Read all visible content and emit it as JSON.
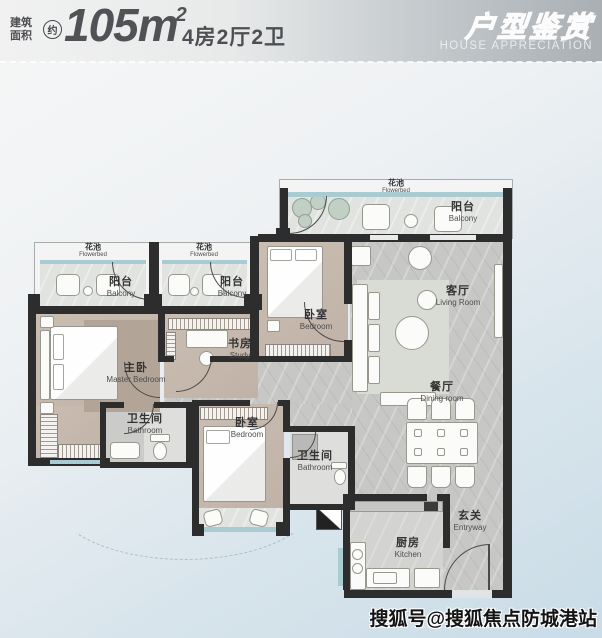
{
  "header": {
    "area_label_line1": "建筑",
    "area_label_line2": "面积",
    "approx_badge": "约",
    "area_value": "105",
    "area_unit": "m",
    "area_exponent": "2",
    "layout_spec": "4房2厅2卫",
    "banner_title_cn": "户型鉴赏",
    "banner_title_en": "HOUSE APPRECIATION"
  },
  "floorplan": {
    "rooms": {
      "flowerbed_top": {
        "cn": "花池",
        "en": "Flowerbed"
      },
      "balcony_top": {
        "cn": "阳台",
        "en": "Balcony"
      },
      "flowerbed_left1": {
        "cn": "花池",
        "en": "Flowerbed"
      },
      "balcony_left1": {
        "cn": "阳台",
        "en": "Balcony"
      },
      "flowerbed_left2": {
        "cn": "花池",
        "en": "Flowerbed"
      },
      "balcony_left2": {
        "cn": "阳台",
        "en": "Balcony"
      },
      "bedroom_top": {
        "cn": "卧室",
        "en": "Bedroom"
      },
      "living_room": {
        "cn": "客厅",
        "en": "Living Room"
      },
      "study": {
        "cn": "书房",
        "en": "Study"
      },
      "master_bedroom": {
        "cn": "主卧",
        "en": "Master Bedroom"
      },
      "dining_room": {
        "cn": "餐厅",
        "en": "Dining room"
      },
      "bathroom_1": {
        "cn": "卫生间",
        "en": "Bathroom"
      },
      "bedroom_bottom": {
        "cn": "卧室",
        "en": "Bedroom"
      },
      "bathroom_2": {
        "cn": "卫生间",
        "en": "Bathroom"
      },
      "kitchen": {
        "cn": "厨房",
        "en": "Kitchen"
      },
      "entryway": {
        "cn": "玄关",
        "en": "Entryway"
      }
    }
  },
  "watermark": "搜狐号@搜狐焦点防城港站",
  "colors": {
    "accent_window_teal": "#a9ccd3",
    "wall_dark": "#2d2d2d",
    "room_beige": "#c7bab0",
    "floor_marble_gray": "#c8c9c7",
    "background_blue": "#c9dce7",
    "header_text_gray": "#515256"
  }
}
